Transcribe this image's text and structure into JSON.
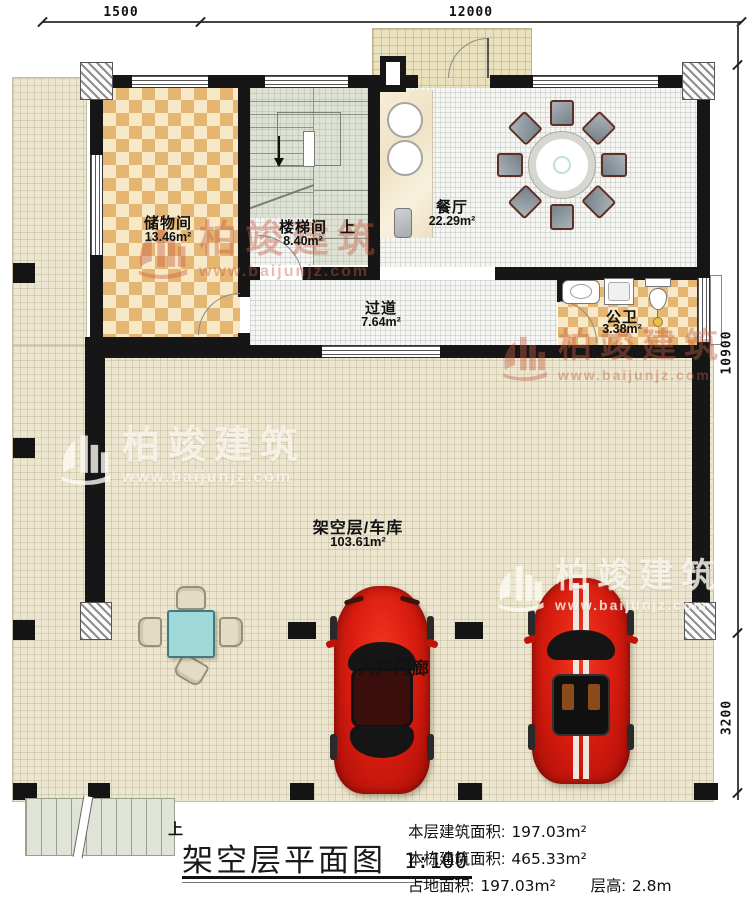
{
  "dimensions": {
    "top_left": "1500",
    "top_main": "12000",
    "right_upper": "10900",
    "right_lower": "3200"
  },
  "rooms": {
    "storage": {
      "name": "储物间",
      "area": "13.46m²"
    },
    "stair": {
      "name": "楼梯间",
      "area": "8.40m²",
      "up": "上"
    },
    "dining": {
      "name": "餐厅",
      "area": "22.29m²"
    },
    "corridor": {
      "name": "过道",
      "area": "7.64m²"
    },
    "bath": {
      "name": "公卫",
      "area": "3.38m²"
    },
    "garage": {
      "name": "架空层/车库",
      "area": "103.61m²"
    },
    "porch": {
      "name": "入户门廊"
    }
  },
  "watermark": {
    "brand": "柏竣建筑",
    "url": "www.baijunjz.com"
  },
  "title_block": {
    "up_label": "上",
    "title": "架空层平面图",
    "scale": "1:100",
    "stats": [
      {
        "label": "本层建筑面积:",
        "value": "197.03m²"
      },
      {
        "label": "本栋建筑面积:",
        "value": "465.33m²"
      },
      {
        "label": "占地面积:",
        "value": "197.03m²"
      },
      {
        "label": "层高:",
        "value": "2.8m"
      }
    ]
  },
  "colors": {
    "wall": "#161616",
    "checker": "#e5b672",
    "apron": "#ece5cf",
    "car_red": "#da1d10",
    "table_teal": "#9fd8d8",
    "watermark_red": "#c65c42"
  }
}
